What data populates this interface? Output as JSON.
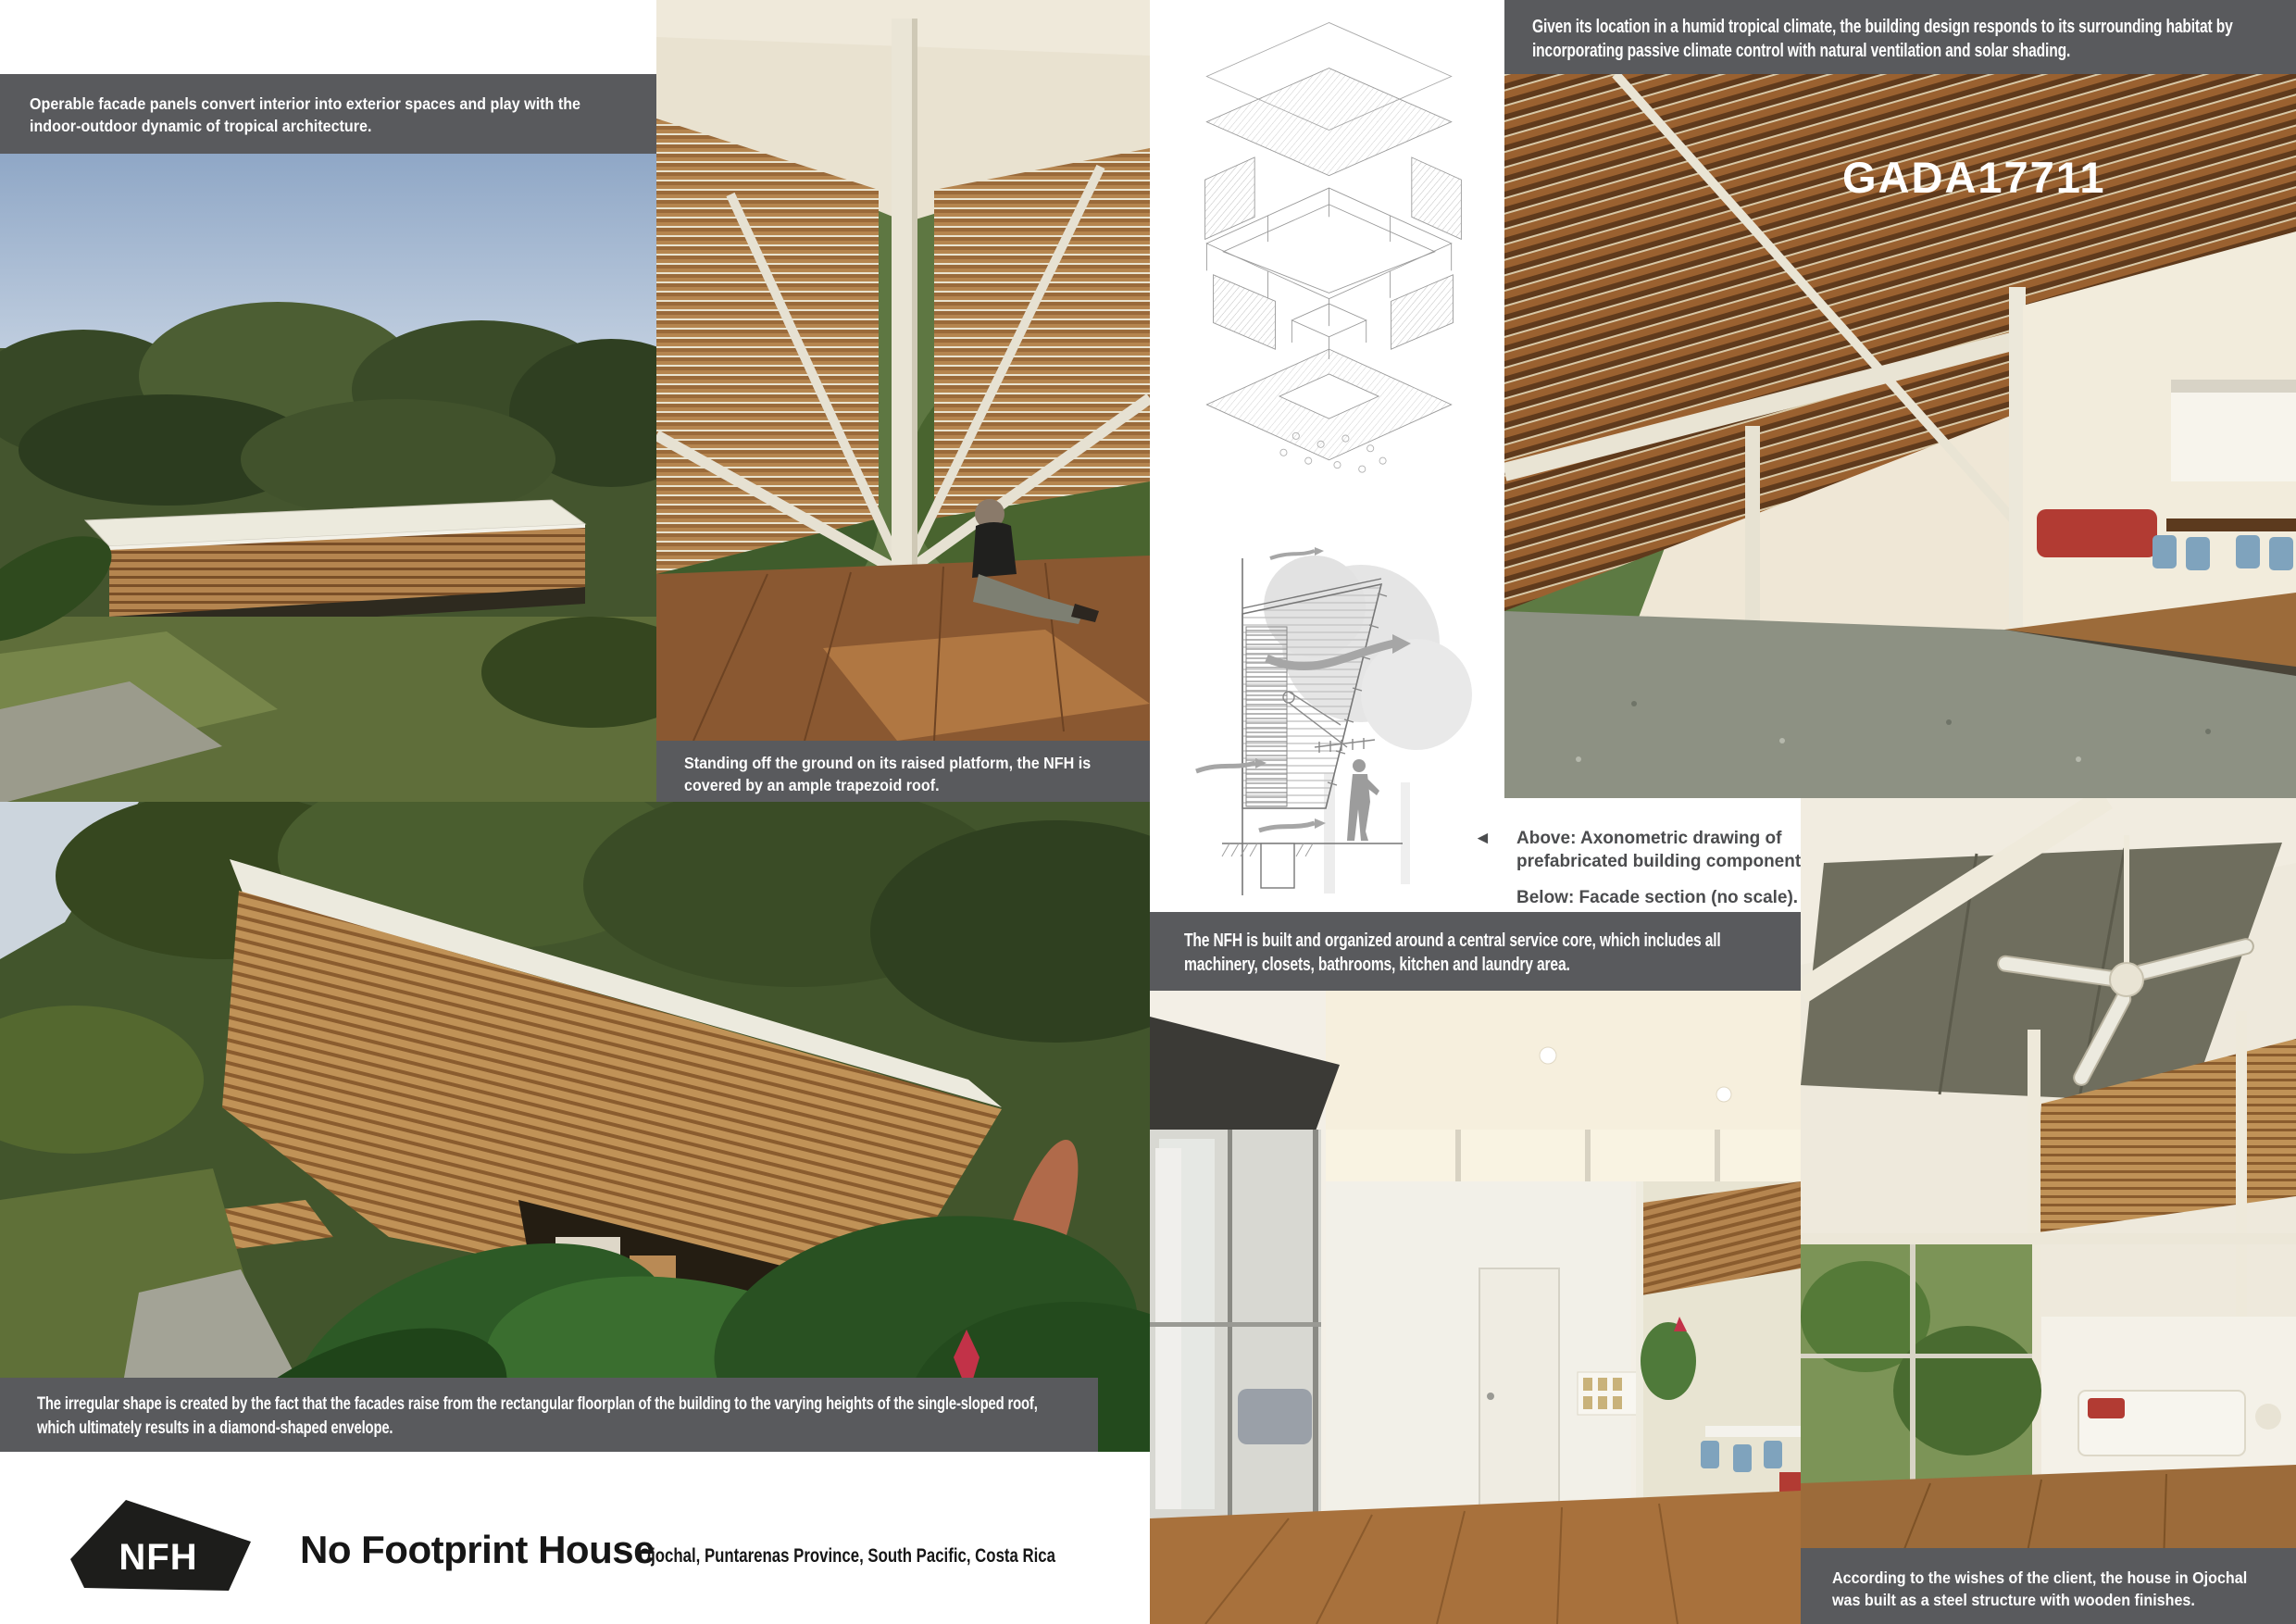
{
  "board": {
    "watermark": "GADA17711",
    "captions": {
      "operable_facade": "Operable facade panels convert interior into exterior spaces and play with the indoor-outdoor dynamic of tropical architecture.",
      "raised_platform": "Standing off the ground on its raised platform, the NFH is covered by an ample trapezoid roof.",
      "climate": "Given its location in a humid tropical climate, the building design responds to its surrounding habitat by incorporating passive climate control with natural ventilation and solar shading.",
      "drawings": {
        "arrow_icon": "◄",
        "above": "Above: Axonometric drawing of prefabricated building components.",
        "below": "Below: Facade section (no scale)."
      },
      "service_core": "The NFH is built and organized around a central service core, which includes all machinery, closets, bathrooms, kitchen and laundry area.",
      "irregular_shape": "The irregular shape is created by the fact that the facades raise from the rectangular floorplan of the building to the varying heights of the single-sloped roof, which ultimately results in a diamond-shaped envelope.",
      "client_wishes": "According to the wishes of the client, the house in Ojochal was built as a steel structure with wooden finishes."
    },
    "footer": {
      "logo": "NFH",
      "title": "No Footprint House",
      "location": "Ojochal, Puntarenas Province, South Pacific, Costa Rica"
    },
    "colors": {
      "caption_bar": "#595a5d",
      "caption_text": "#ffffff",
      "drawing_caption_text": "#4b4c4e",
      "logo_fill": "#1d1d1b",
      "logo_text": "#ffffff",
      "watermark": "#ffffff",
      "background": "#ffffff"
    }
  }
}
